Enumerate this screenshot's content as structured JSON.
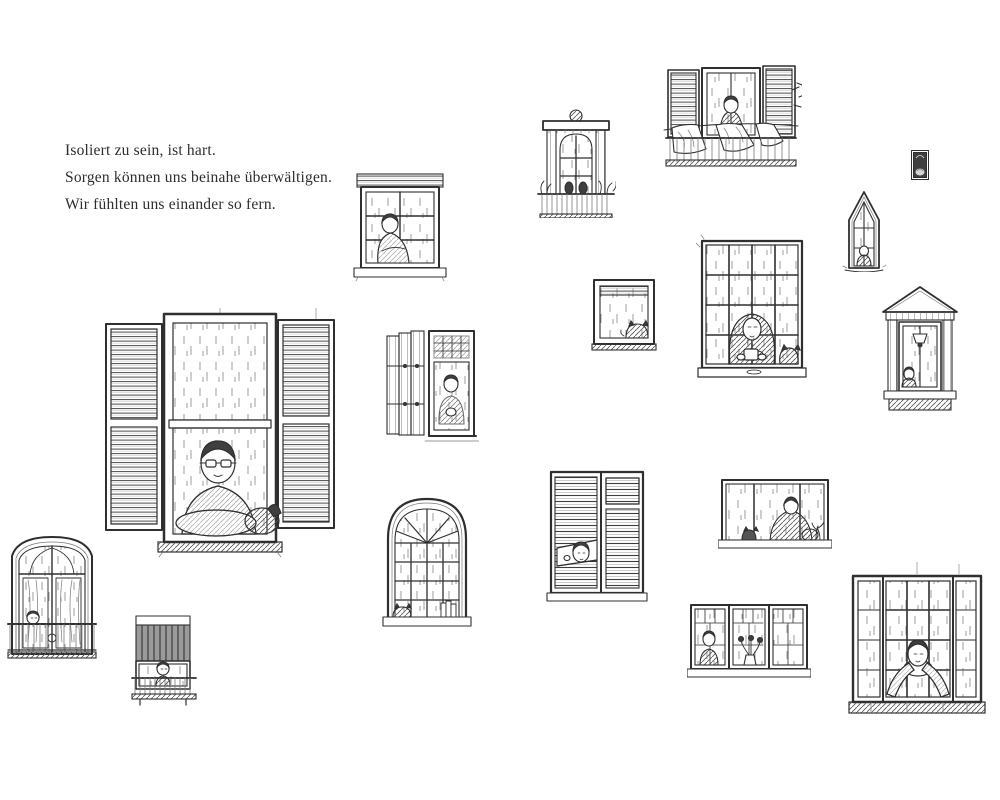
{
  "page": {
    "description": "Illustrated picture-book spread: scattered hand-drawn ink sketches of many different windows, each with lonely people or pets looking out while it rains",
    "background": "#ffffff"
  },
  "palette": {
    "ink": "#2f2f2f",
    "paper": "#ffffff",
    "shade": "#7a7a7a"
  },
  "text_block": {
    "lines": [
      "Isoliert zu sein, ist hart.",
      "Sorgen können uns beinahe überwältigen.",
      "Wir fühlten uns einander so fern."
    ]
  },
  "illustrations": [
    {
      "name": "window-sash-man-dog",
      "description": "Large sash window with open louvered shutters; an older man with glasses leans on the sill beside his dog while rain falls"
    },
    {
      "name": "window-grid-person-hugging-knees",
      "description": "Small gridded window; a long-haired person sits hugging their knees behind the glass"
    },
    {
      "name": "window-ornate-balcony-plants",
      "description": "Tall classical window with carved cornice and round ornament above a plant-filled balcony railing"
    },
    {
      "name": "window-balcony-laundry",
      "description": "Shuttered balcony window with a standing figure; laundry sheets drape over the railing as leaves blow away"
    },
    {
      "name": "window-tiny-dark",
      "description": "Tiny distant dark window with a small curled shape inside"
    },
    {
      "name": "window-gothic-arch",
      "description": "Pointed gothic arch window with a small figure seated at its base"
    },
    {
      "name": "window-grid-woman-mug-cat",
      "description": "Large sixteen-pane window; a woman with long hair cradles a warm mug while a cat sits on the sill"
    },
    {
      "name": "window-square-cat",
      "description": "Small square window with a cat curled in the lower corner"
    },
    {
      "name": "window-pediment-lamp-child",
      "description": "Classical pedimented window with pilasters, a hanging lamp and a small child peeking from the corner"
    },
    {
      "name": "window-folding-shutters-person",
      "description": "Tall window with folded wooden shutters; a seated figure looks down at clasped hands"
    },
    {
      "name": "window-french-balcony-child",
      "description": "Arched French window with curtains and balcony railing; a child peeks from the lower corner"
    },
    {
      "name": "window-roller-shutter-child",
      "description": "Small balcony window with its rolling shutter half closed; a child's head peeks over the rail"
    },
    {
      "name": "window-arched-fanlight-cat",
      "description": "Arched window with radiating fanlight; a cat naps on the sill beside a stack of books"
    },
    {
      "name": "window-blinds-child-peeking",
      "description": "Window covered by venetian blinds; a child pulls the slats apart to peek out"
    },
    {
      "name": "window-wide-blanket-figure",
      "description": "Wide horizontal window with a figure wrapped in a blanket, a cat and a plant on the sill"
    },
    {
      "name": "window-triple-flowers",
      "description": "Wide triple casement window with a figure at one side and a vase of flowers in the middle"
    },
    {
      "name": "window-sash-person-leaning",
      "description": "Large sash window with sidelights; a person leans forward with arms spread wide on the sill"
    }
  ]
}
